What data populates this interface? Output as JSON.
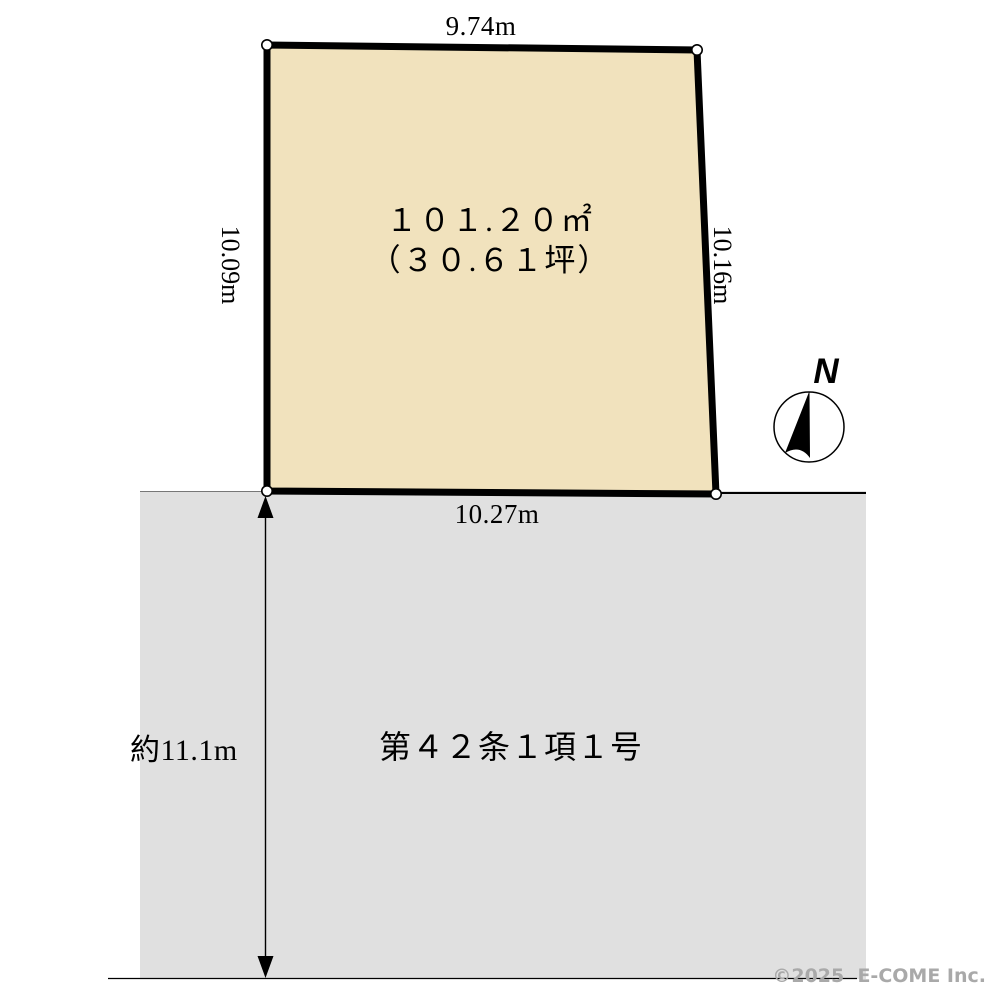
{
  "lot": {
    "fill_color": "#f1e2bd",
    "area_line1": "１０１.２０㎡",
    "area_line2": "（３０.６１坪）",
    "dimensions": {
      "top": "9.74m",
      "left": "10.09m",
      "right": "10.16m",
      "bottom": "10.27m"
    }
  },
  "road": {
    "fill_color": "#e0e0e0",
    "label": "第４２条１項１号",
    "width_label": "約11.1m"
  },
  "compass": {
    "label": "N"
  },
  "footer": {
    "copyright": "©2025  E-COME Inc."
  }
}
